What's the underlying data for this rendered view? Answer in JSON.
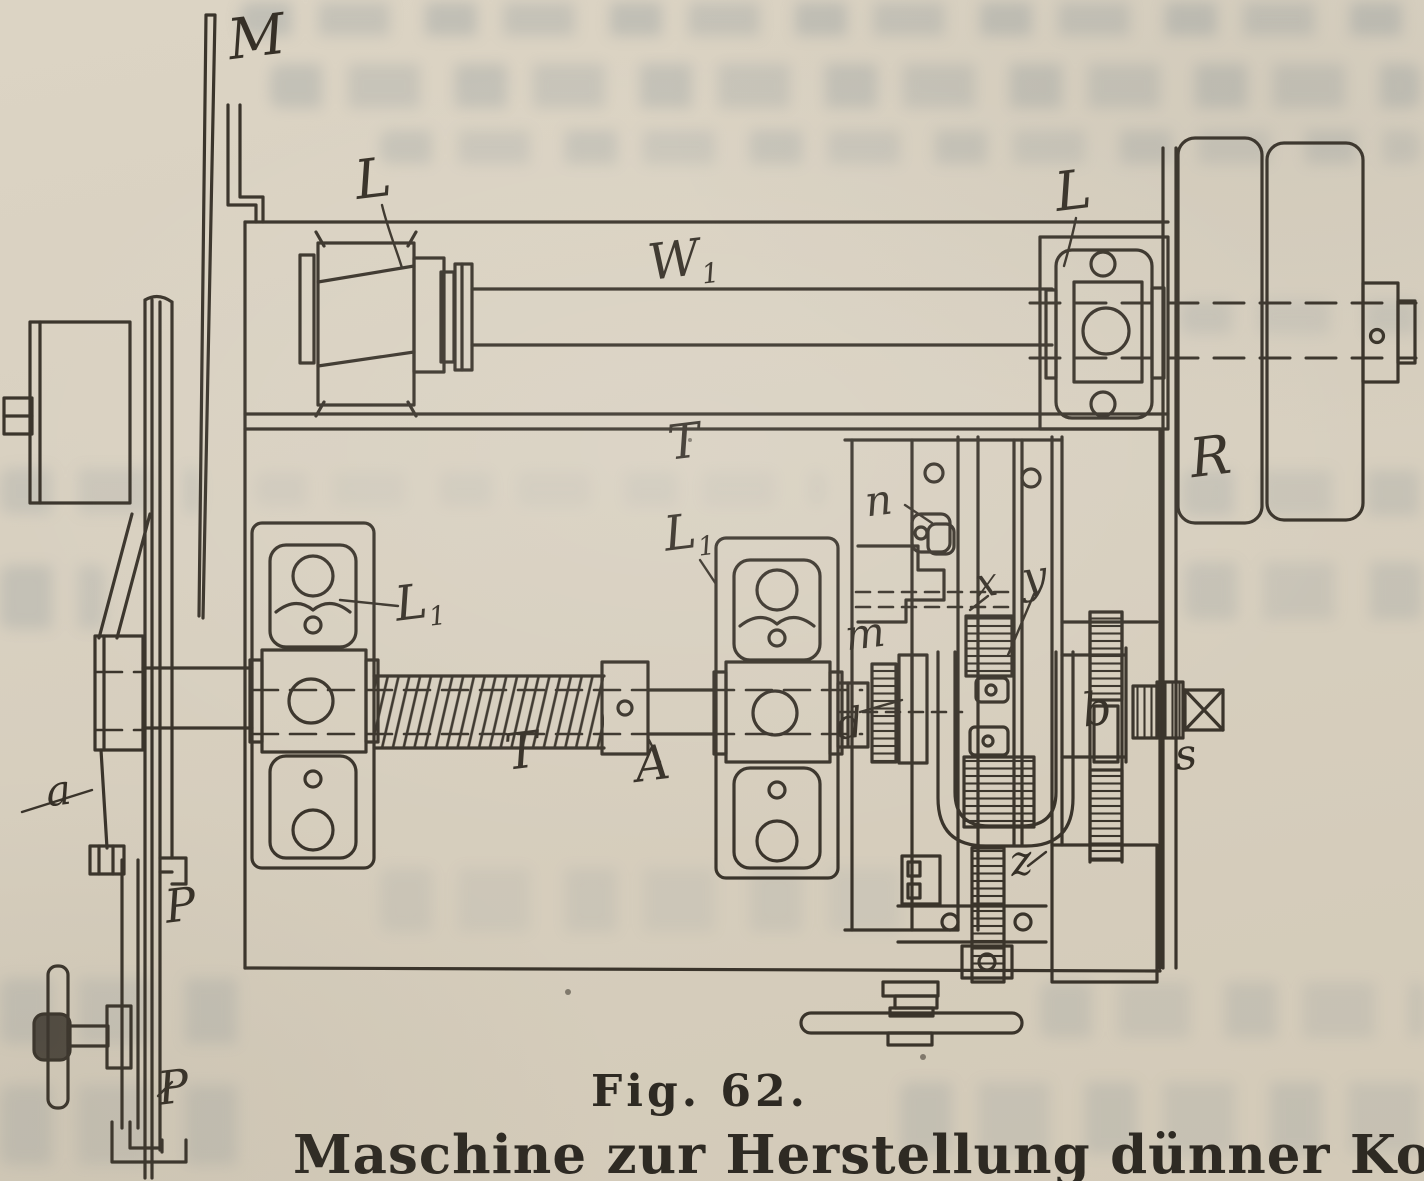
{
  "figure": {
    "fig_label": "Fig. 62.",
    "caption": "Maschine zur Herstellung dünner Korkbl"
  },
  "diagram": {
    "ink_color": "#3a342b",
    "paper_color": "#d8d0c0",
    "bleed_color": "#7c8a92",
    "labels": [
      {
        "id": "m-blade",
        "text": "M",
        "x": 228,
        "y": 10,
        "size": 56
      },
      {
        "id": "l-bearing-left",
        "text": "L",
        "x": 355,
        "y": 152,
        "size": 54
      },
      {
        "id": "w1-shaft",
        "text": "W",
        "sub": "1",
        "x": 648,
        "y": 234,
        "size": 50
      },
      {
        "id": "l-bearing-right",
        "text": "L",
        "x": 1055,
        "y": 164,
        "size": 54
      },
      {
        "id": "r-pulley",
        "text": "R",
        "x": 1190,
        "y": 430,
        "size": 54
      },
      {
        "id": "t-table",
        "text": "T",
        "x": 668,
        "y": 418,
        "size": 48
      },
      {
        "id": "l1-bearing-left",
        "text": "L",
        "sub": "1",
        "x": 395,
        "y": 578,
        "size": 48
      },
      {
        "id": "l1-bearing-right",
        "text": "L",
        "sub": "1",
        "x": 664,
        "y": 508,
        "size": 48
      },
      {
        "id": "t-feed-screw",
        "text": "T",
        "x": 505,
        "y": 726,
        "size": 50
      },
      {
        "id": "a-coupling",
        "text": "A",
        "x": 635,
        "y": 740,
        "size": 48
      },
      {
        "id": "n-pawl",
        "text": "n",
        "x": 865,
        "y": 480,
        "size": 42
      },
      {
        "id": "x-gear",
        "text": "x",
        "x": 975,
        "y": 563,
        "size": 40
      },
      {
        "id": "y-gear",
        "text": "y",
        "x": 1022,
        "y": 556,
        "size": 44
      },
      {
        "id": "m-clutch",
        "text": "m",
        "x": 845,
        "y": 613,
        "size": 42
      },
      {
        "id": "d-gear",
        "text": "d",
        "x": 836,
        "y": 703,
        "size": 42
      },
      {
        "id": "b-ratchet",
        "text": "b",
        "x": 1082,
        "y": 686,
        "size": 46
      },
      {
        "id": "s-square-end",
        "text": "s",
        "x": 1175,
        "y": 734,
        "size": 42
      },
      {
        "id": "z-screw",
        "text": "z",
        "x": 1010,
        "y": 840,
        "size": 42
      },
      {
        "id": "a-lever",
        "text": "a",
        "x": 46,
        "y": 770,
        "size": 42
      },
      {
        "id": "p-pedal-upper",
        "text": "P",
        "x": 165,
        "y": 882,
        "size": 46
      },
      {
        "id": "p-pedal-lower",
        "text": "P",
        "x": 158,
        "y": 1064,
        "size": 46
      }
    ]
  }
}
